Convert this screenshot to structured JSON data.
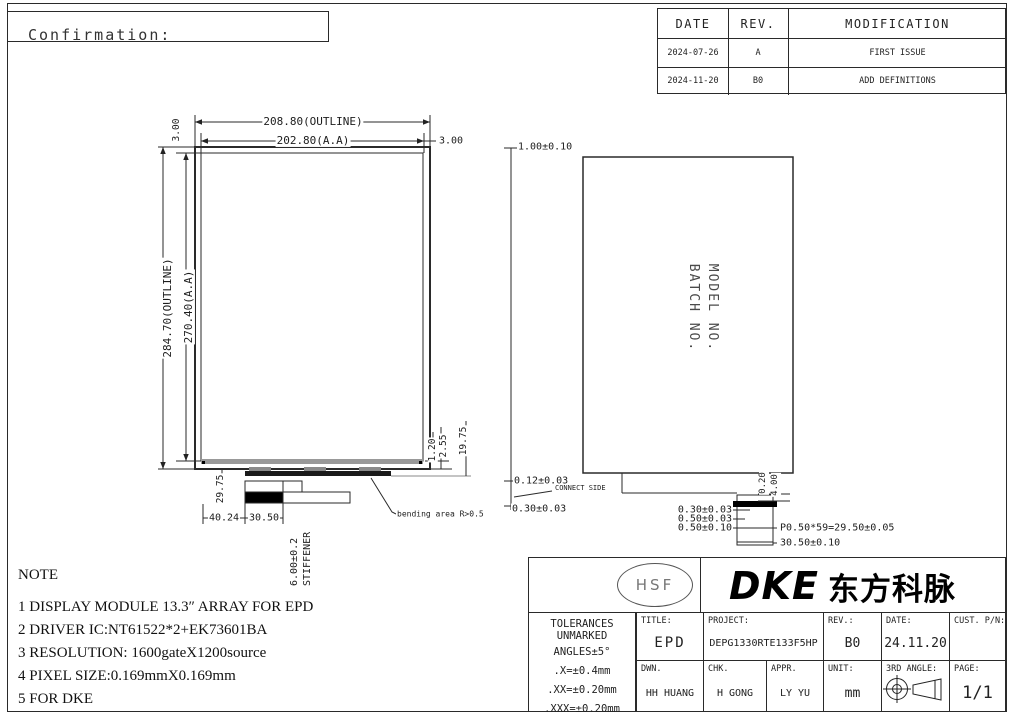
{
  "header": {
    "confirmation": "Confirmation:"
  },
  "revision_table": {
    "col_date": "DATE",
    "col_rev": "REV.",
    "col_mod": "MODIFICATION",
    "rows": [
      {
        "date": "2024-07-26",
        "rev": "A",
        "mod": "FIRST ISSUE"
      },
      {
        "date": "2024-11-20",
        "rev": "B0",
        "mod": "ADD DEFINITIONS"
      }
    ]
  },
  "front_view": {
    "outline_width": "208.80(OUTLINE)",
    "aa_width": "202.80(A.A)",
    "margin_left": "3.00",
    "margin_right": "3.00",
    "outline_height": "284.70(OUTLINE)",
    "aa_height": "270.40(A.A)",
    "ledge_a": "1.20",
    "ledge_b": "2.55",
    "fpc_length": "19.75",
    "conn_offset_v": "29.75",
    "conn_offset_h": "40.24",
    "stiffener_width": "30.50",
    "stiffener_thickness": "6.00±0.2",
    "stiffener_label": "STIFFENER",
    "bending_note": "bending area R>0.5"
  },
  "side_view": {
    "thickness": "1.00±0.10",
    "marking_line1": "MODEL NO.",
    "marking_line2": "BATCH NO.",
    "step_top": "0.12±0.03",
    "connect_side": "CONNECT SIDE",
    "step_bottom": "0.30±0.03",
    "conn_dim_a": "0.20",
    "conn_dim_b": "4.00",
    "stack_a": "0.30±0.03",
    "stack_b": "0.50±0.03",
    "stack_c": "0.50±0.10",
    "pin_pitch": "P0.50*59=29.50±0.05",
    "conn_width": "30.50±0.10"
  },
  "note": {
    "title": "NOTE",
    "line1": "1 DISPLAY MODULE 13.3″ ARRAY FOR EPD",
    "line2": "2 DRIVER IC:NT61522*2+EK73601BA",
    "line3": "3 RESOLUTION: 1600gateX1200source",
    "line4": "4 PIXEL SIZE:0.169mmX0.169mm",
    "line5": "5 FOR DKE"
  },
  "logo": {
    "hsf": "HSF",
    "brand": "DKE",
    "brand_cjk": "东方科脉"
  },
  "title_block": {
    "tol1": "TOLERANCES",
    "tol2": "UNMARKED",
    "tol3": "ANGLES±5°",
    "tol_x": ".X=±0.4mm",
    "tol_xx": ".XX=±0.20mm",
    "tol_xxx": ".XXX=±0.20mm",
    "title_label": "TITLE:",
    "title_value": "EPD",
    "project_label": "PROJECT:",
    "project_value": "DEPG1330RTE133F5HP",
    "rev_label": "REV.:",
    "rev_value": "B0",
    "date_label": "DATE:",
    "date_value": "24.11.20",
    "cust_label": "CUST. P/N:",
    "cust_value": "",
    "dwn_label": "DWN.",
    "dwn_value": "HH HUANG",
    "chk_label": "CHK.",
    "chk_value": "H GONG",
    "appr_label": "APPR.",
    "appr_value": "LY YU",
    "unit_label": "UNIT:",
    "unit_value": "mm",
    "angle_label": "3RD ANGLE:",
    "page_label": "PAGE:",
    "page_value": "1/1"
  }
}
